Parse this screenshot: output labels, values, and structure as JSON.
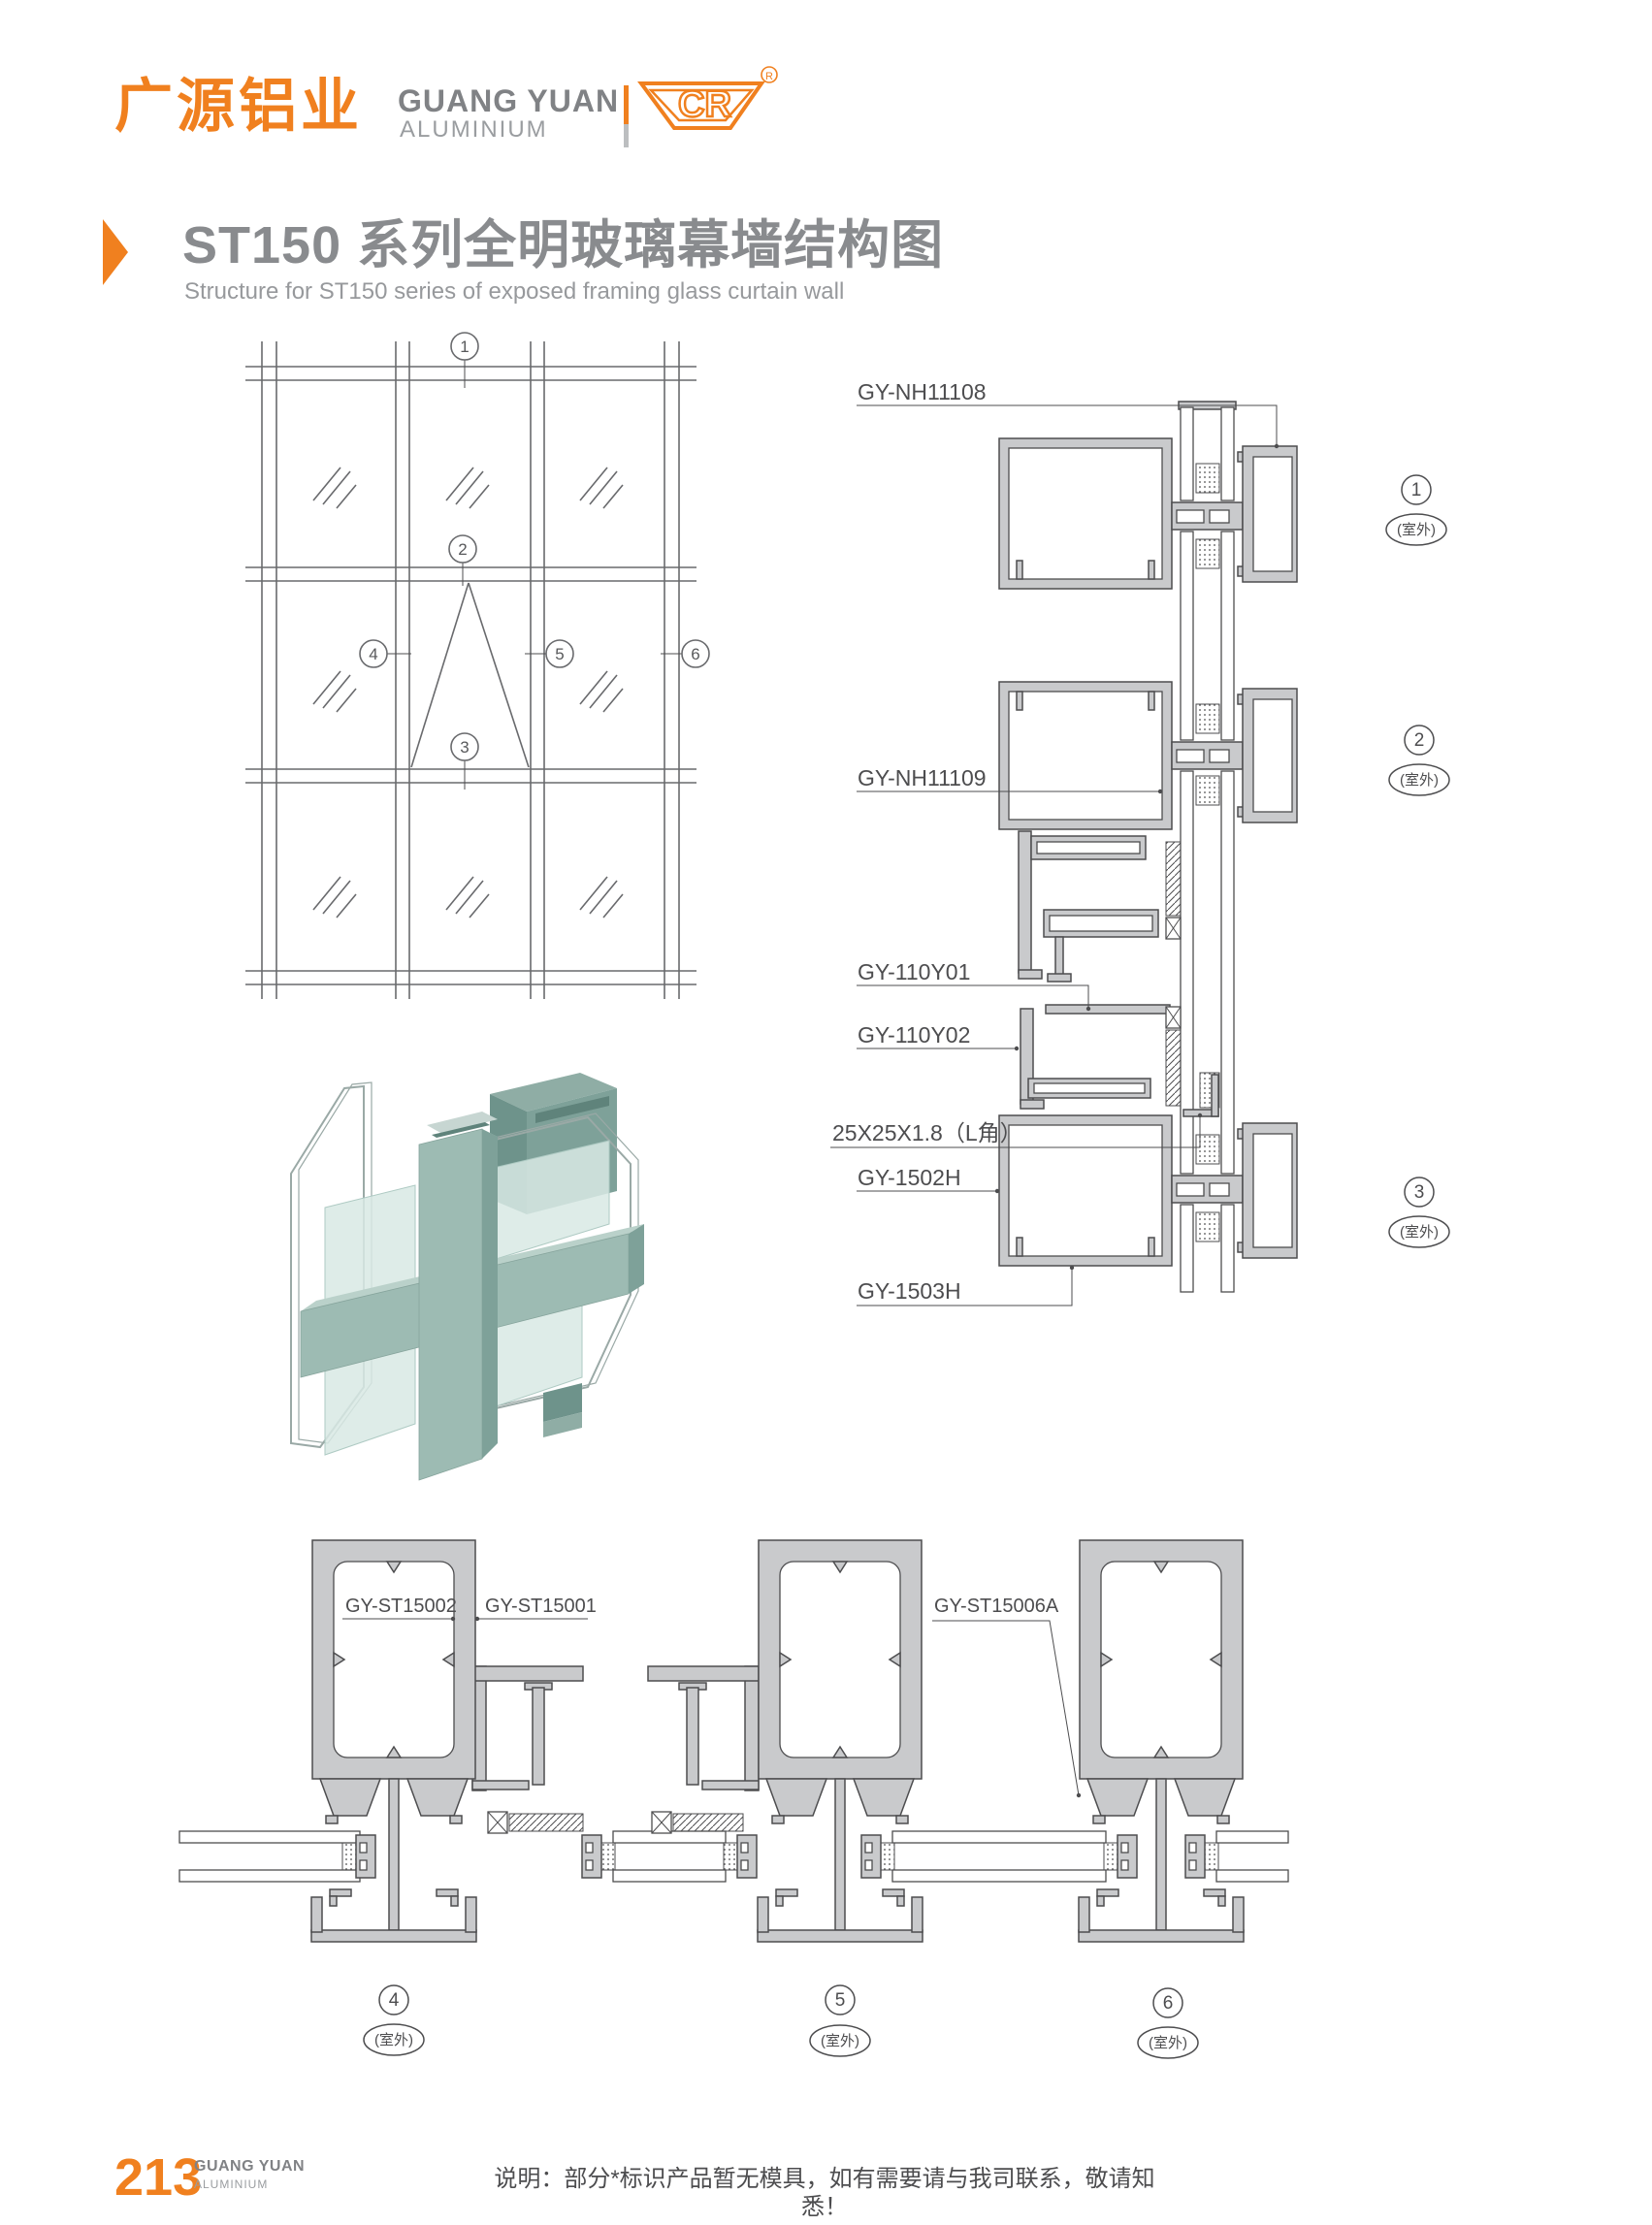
{
  "colors": {
    "orange": "#F0801F",
    "title_gray": "#898B8E",
    "line_gray": "#4D4D4F",
    "profile_fill": "#C9CACC",
    "render_green": "#9DBBB3"
  },
  "header": {
    "logo_cn": "广源铝业",
    "logo_en": "GUANG YUAN",
    "logo_en_sub": "ALUMINIUM",
    "cr_text": "CR",
    "registered": "®"
  },
  "title": {
    "zh": "ST150 系列全明玻璃幕墙结构图",
    "en": "Structure for ST150 series of exposed framing glass curtain wall"
  },
  "elevation": {
    "callouts": [
      "1",
      "2",
      "3",
      "4",
      "5",
      "6"
    ]
  },
  "vertical_section": {
    "labels": [
      "GY-NH11108",
      "GY-NH11109",
      "GY-110Y01",
      "GY-110Y02",
      "25X25X1.8（L角）",
      "GY-1502H",
      "GY-1503H"
    ],
    "callouts": [
      {
        "num": "1",
        "loc": "(室外)"
      },
      {
        "num": "2",
        "loc": "(室外)"
      },
      {
        "num": "3",
        "loc": "(室外)"
      }
    ]
  },
  "horizontal_section": {
    "labels": [
      "GY-ST15002",
      "GY-ST15001",
      "GY-ST15006A"
    ],
    "callouts": [
      {
        "num": "4",
        "loc": "(室外)"
      },
      {
        "num": "5",
        "loc": "(室外)"
      },
      {
        "num": "6",
        "loc": "(室外)"
      }
    ]
  },
  "footer": {
    "page": "213",
    "brand": "GUANG YUAN",
    "brand_sub": "ALUMINIUM",
    "note": "说明：部分*标识产品暂无模具，如有需要请与我司联系，敬请知悉！"
  }
}
